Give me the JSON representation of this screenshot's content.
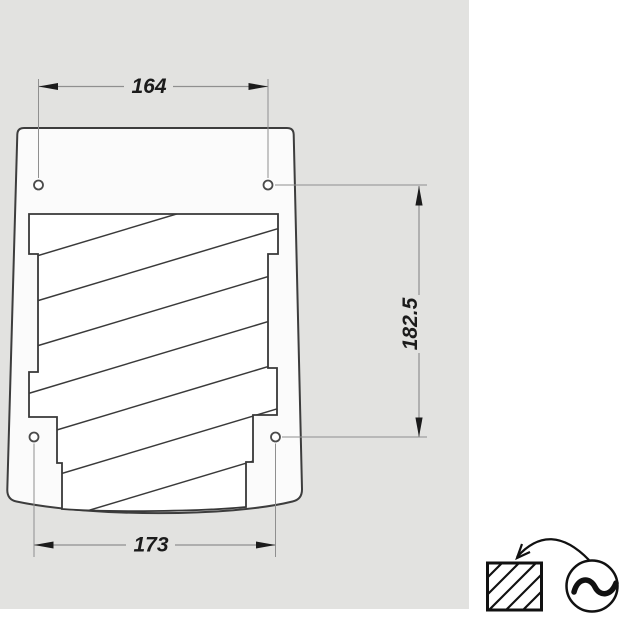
{
  "drawing": {
    "kind": "mounting-template-dimension-drawing",
    "dimensions": {
      "top_hole_spacing": "164",
      "bottom_hole_spacing": "173",
      "vertical_hole_spacing": "182.5"
    },
    "mounting_holes_count": 4,
    "colors": {
      "canvas_background": "#e2e2e0",
      "page_background": "#ffffff",
      "template_fill": "#fbfbfb",
      "outline_stroke": "#3d3d3d",
      "hatch_stroke": "#3a3a3a",
      "dimension_line": "#8f8f8f",
      "dimension_text": "#1b1b1b",
      "legend_stroke": "#111111"
    },
    "legend": {
      "icons": {
        "box": "hatched-box",
        "arrow": "curved-arrow",
        "power": "ac-sine-symbol"
      }
    }
  }
}
